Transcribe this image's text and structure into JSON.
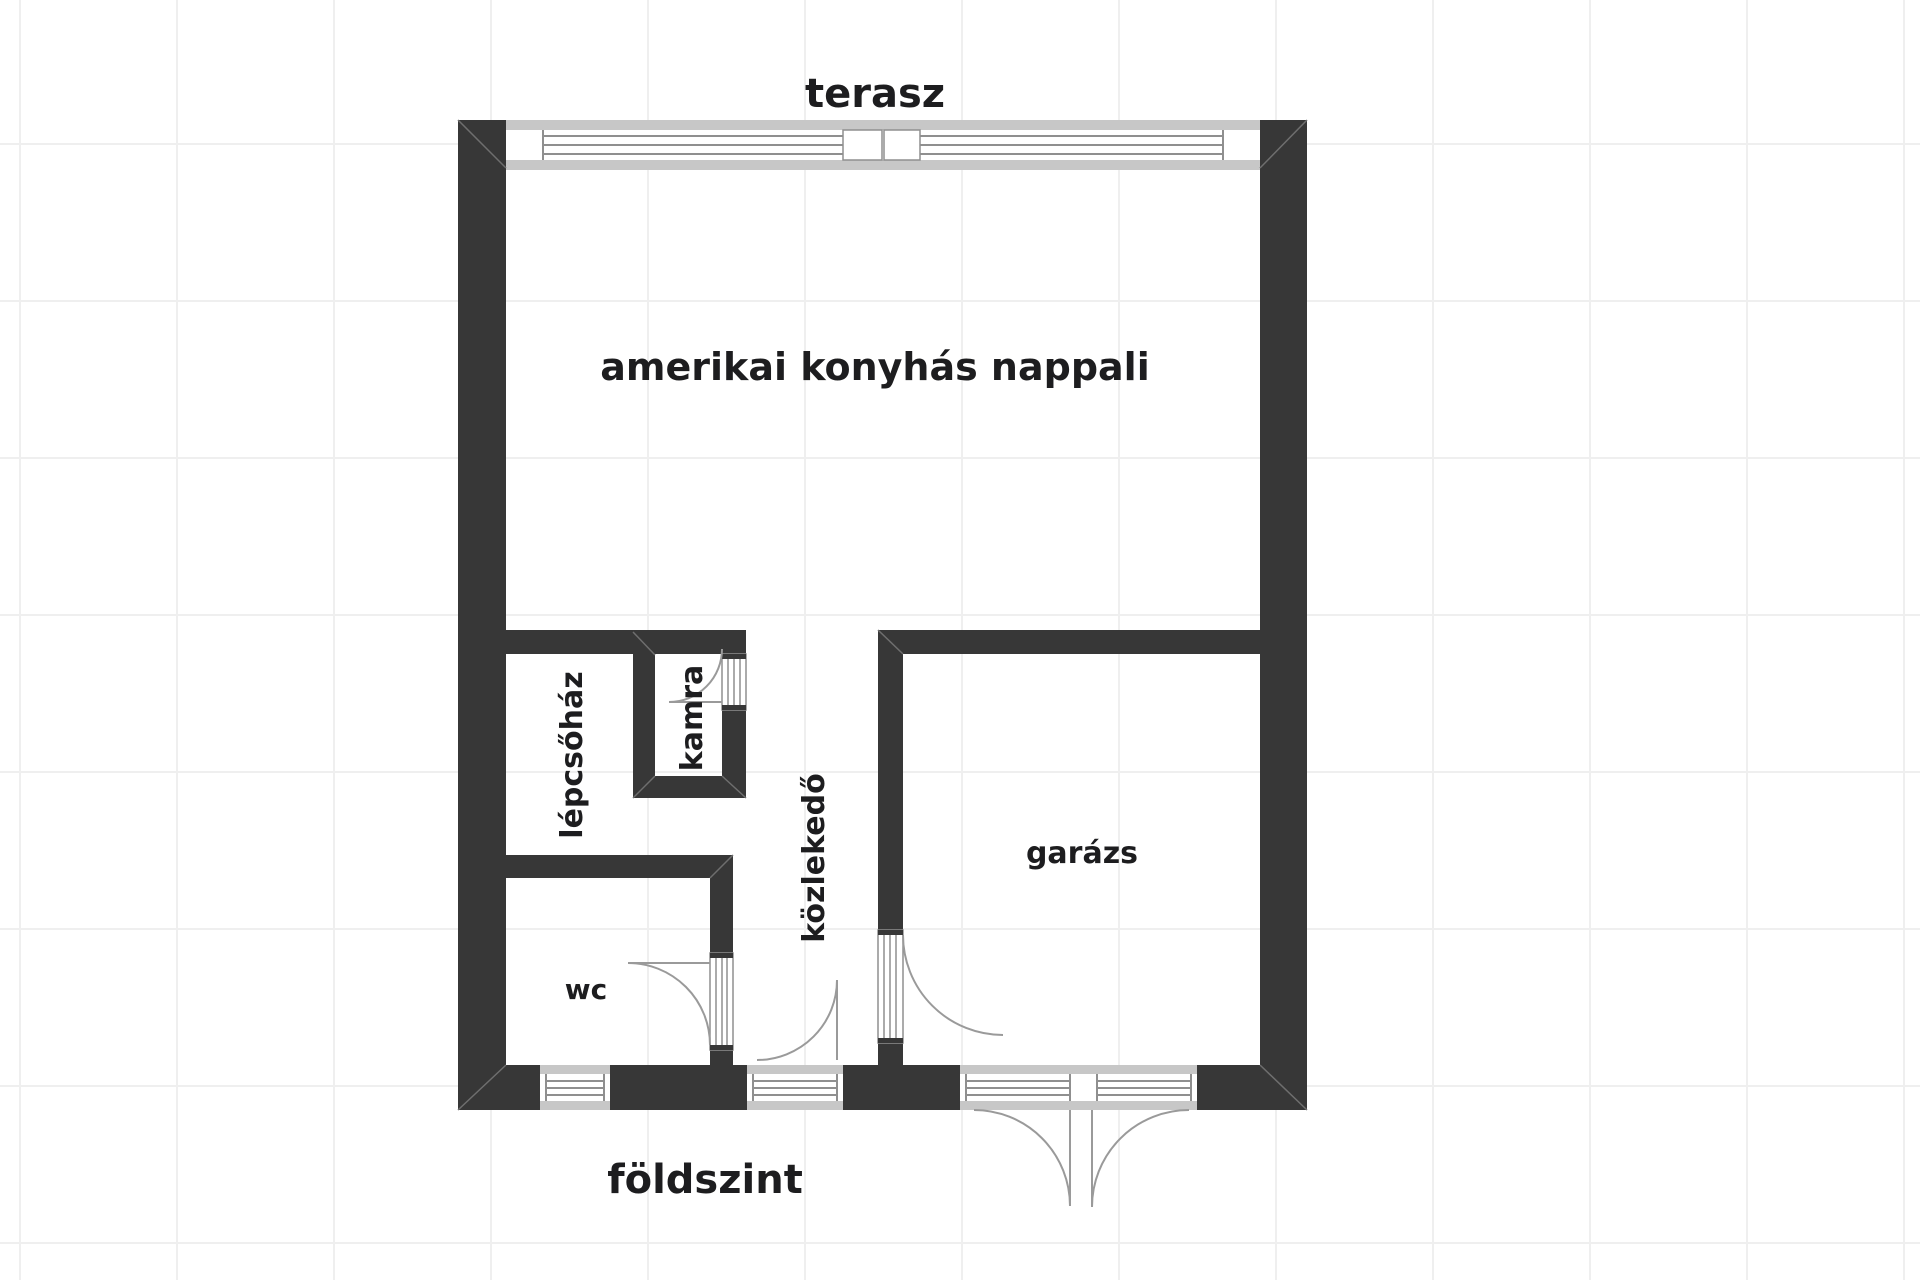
{
  "plan": {
    "floor_title": "földszint",
    "outside_label": "terasz"
  },
  "rooms": {
    "living_room": "amerikai konyhás nappali",
    "staircase": "lépcsőház",
    "pantry": "kamra",
    "hallway": "közlekedő",
    "garage": "garázs",
    "wc": "wc"
  },
  "colors": {
    "wall": "#373737",
    "window_frame": "#c7c7c7",
    "glazing_line": "#8f8f8f",
    "door_swing": "#9a9a9a",
    "text": "#1d1d1f",
    "grid_line": "#efefef",
    "background": "#ffffff"
  }
}
